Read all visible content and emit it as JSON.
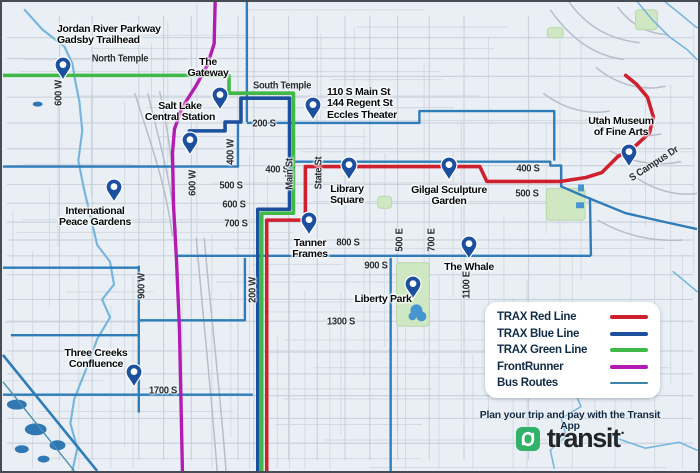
{
  "colors": {
    "red": "#cf2030",
    "blue": "#1c4f9e",
    "green": "#41b949",
    "frontrunner": "#b31cb3",
    "bus": "#2e7cb8",
    "bus_thin": "#4a8fb0",
    "bus_legend": "#3d85a8",
    "water": "#77b6dc",
    "water_fill": "#2f77b5",
    "pond": "#4596d0",
    "park": "#cfe7c2",
    "park_edge": "#b7d8a8",
    "pin": "#1c4f9e",
    "grid_minor": "#d4dae1",
    "grid_major": "#c6cdd6",
    "decor": "#b7bec8"
  },
  "legend": {
    "items": [
      {
        "label": "TRAX Red Line",
        "color": "red",
        "weight": 4
      },
      {
        "label": "TRAX Blue Line",
        "color": "blue",
        "weight": 4
      },
      {
        "label": "TRAX Green Line",
        "color": "green",
        "weight": 4
      },
      {
        "label": "FrontRunner",
        "color": "frontrunner",
        "weight": 4
      },
      {
        "label": "Bus Routes",
        "color": "bus_legend",
        "weight": 2
      }
    ]
  },
  "footer": {
    "tagline": "Plan your trip and pay with the Transit App",
    "brand": "transit",
    "mark": "·"
  },
  "map": {
    "street_labels": [
      {
        "text": "North Temple",
        "x": 118,
        "y": 57,
        "rot": 0
      },
      {
        "text": "600 W",
        "x": 57,
        "y": 91,
        "rot": -90
      },
      {
        "text": "South Temple",
        "x": 280,
        "y": 84,
        "rot": 0
      },
      {
        "text": "200 S",
        "x": 262,
        "y": 122,
        "rot": 0
      },
      {
        "text": "400 W",
        "x": 229,
        "y": 150,
        "rot": -90
      },
      {
        "text": "600 W",
        "x": 191,
        "y": 181,
        "rot": -90
      },
      {
        "text": "400 S",
        "x": 275,
        "y": 168,
        "rot": 0
      },
      {
        "text": "500 S",
        "x": 229,
        "y": 184,
        "rot": 0
      },
      {
        "text": "600 S",
        "x": 232,
        "y": 203,
        "rot": 0
      },
      {
        "text": "700 S",
        "x": 234,
        "y": 222,
        "rot": 0
      },
      {
        "text": "Main St",
        "x": 288,
        "y": 172,
        "rot": -90
      },
      {
        "text": "State St",
        "x": 317,
        "y": 171,
        "rot": -90
      },
      {
        "text": "800 S",
        "x": 346,
        "y": 241,
        "rot": 0
      },
      {
        "text": "900 S",
        "x": 374,
        "y": 264,
        "rot": 0
      },
      {
        "text": "500 E",
        "x": 398,
        "y": 238,
        "rot": -90
      },
      {
        "text": "700 E",
        "x": 430,
        "y": 238,
        "rot": -90
      },
      {
        "text": "1300 S",
        "x": 339,
        "y": 320,
        "rot": 0
      },
      {
        "text": "1100 E",
        "x": 465,
        "y": 283,
        "rot": -90
      },
      {
        "text": "900 W",
        "x": 140,
        "y": 284,
        "rot": -90
      },
      {
        "text": "200 W",
        "x": 251,
        "y": 288,
        "rot": -90
      },
      {
        "text": "1700 S",
        "x": 161,
        "y": 389,
        "rot": 0
      },
      {
        "text": "400 S",
        "x": 526,
        "y": 167,
        "rot": 0
      },
      {
        "text": "500 S",
        "x": 525,
        "y": 192,
        "rot": 0
      },
      {
        "text": "S Campus Dr",
        "x": 652,
        "y": 162,
        "rot": -33
      }
    ],
    "markers": [
      {
        "id": "jordan-river-parkway",
        "lines": [
          "Jordan River Parkway",
          "Gadsby Trailhead"
        ],
        "tip": [
          61,
          78
        ],
        "lx": 55,
        "ly": 22,
        "align": "left"
      },
      {
        "id": "the-gateway",
        "lines": [
          "The",
          "Gateway"
        ],
        "tip": [
          218,
          108
        ],
        "lx": 206,
        "ly": 55,
        "align": "center"
      },
      {
        "id": "salt-lake-central-station",
        "lines": [
          "Salt Lake",
          "Central Station"
        ],
        "tip": [
          188,
          153
        ],
        "lx": 178,
        "ly": 99,
        "align": "center"
      },
      {
        "id": "eccles-theater",
        "lines": [
          "110 S Main St",
          "144 Regent St",
          "Eccles Theater"
        ],
        "tip": [
          311,
          118
        ],
        "lx": 325,
        "ly": 85,
        "align": "left"
      },
      {
        "id": "library-square",
        "lines": [
          "Library",
          "Square"
        ],
        "tip": [
          347,
          178
        ],
        "lx": 345,
        "ly": 182,
        "align": "center"
      },
      {
        "id": "gilgal-sculpture-garden",
        "lines": [
          "Gilgal Sculpture",
          "Garden"
        ],
        "tip": [
          447,
          178
        ],
        "lx": 447,
        "ly": 183,
        "align": "center"
      },
      {
        "id": "utah-museum-of-fine-arts",
        "lines": [
          "Utah Museum",
          "of Fine Arts"
        ],
        "tip": [
          627,
          165
        ],
        "lx": 619,
        "ly": 114,
        "align": "center"
      },
      {
        "id": "international-peace-gardens",
        "lines": [
          "International",
          "Peace Gardens"
        ],
        "tip": [
          112,
          200
        ],
        "lx": 93,
        "ly": 204,
        "align": "center"
      },
      {
        "id": "tanner-frames",
        "lines": [
          "Tanner",
          "Frames"
        ],
        "tip": [
          307,
          233
        ],
        "lx": 308,
        "ly": 236,
        "align": "center"
      },
      {
        "id": "the-whale",
        "lines": [
          "The Whale"
        ],
        "tip": [
          467,
          257
        ],
        "lx": 467,
        "ly": 260,
        "align": "center"
      },
      {
        "id": "liberty-park",
        "lines": [
          "Liberty Park"
        ],
        "tip": [
          411,
          297
        ],
        "lx": 381,
        "ly": 292,
        "align": "center"
      },
      {
        "id": "three-creeks-confluence",
        "lines": [
          "Three Creeks",
          "Confluence"
        ],
        "tip": [
          132,
          385
        ],
        "lx": 94,
        "ly": 346,
        "align": "center"
      }
    ],
    "routes": [
      {
        "name": "bus-400-s-west",
        "color": "bus",
        "width": 2.4,
        "points": [
          [
            0,
            166
          ],
          [
            237,
            166
          ]
        ]
      },
      {
        "name": "bus-400-w",
        "color": "bus",
        "width": 2.4,
        "points": [
          [
            237,
            121
          ],
          [
            237,
            167
          ]
        ]
      },
      {
        "name": "bus-300-w",
        "color": "bus",
        "width": 2.4,
        "points": [
          [
            246,
            0
          ],
          [
            246,
            121
          ]
        ]
      },
      {
        "name": "bus-200-s",
        "color": "bus",
        "width": 2.4,
        "points": [
          [
            246,
            122
          ],
          [
            420,
            122
          ],
          [
            420,
            110
          ],
          [
            556,
            110
          ],
          [
            556,
            160
          ]
        ]
      },
      {
        "name": "bus-400-s-east",
        "color": "bus",
        "width": 2.4,
        "points": [
          [
            293,
            161
          ],
          [
            552,
            161
          ],
          [
            552,
            165
          ],
          [
            563,
            165
          ],
          [
            563,
            186
          ],
          [
            584,
            195
          ],
          [
            628,
            213
          ],
          [
            668,
            222
          ],
          [
            700,
            229
          ]
        ]
      },
      {
        "name": "bus-900-s",
        "color": "bus",
        "width": 2.4,
        "points": [
          [
            174,
            256
          ],
          [
            593,
            256
          ]
        ]
      },
      {
        "name": "bus-900-s-connector",
        "color": "bus",
        "width": 2.4,
        "points": [
          [
            592,
            197
          ],
          [
            593,
            256
          ]
        ]
      },
      {
        "name": "bus-600-e",
        "color": "bus",
        "width": 2.4,
        "points": [
          [
            391,
            258
          ],
          [
            391,
            473
          ]
        ]
      },
      {
        "name": "bus-200-w",
        "color": "bus",
        "width": 2.4,
        "points": [
          [
            244,
            258
          ],
          [
            244,
            321
          ],
          [
            137,
            321
          ]
        ]
      },
      {
        "name": "bus-900-w",
        "color": "bus",
        "width": 2.4,
        "points": [
          [
            137,
            266
          ],
          [
            137,
            414
          ]
        ]
      },
      {
        "name": "bus-california-ave",
        "color": "bus",
        "width": 2.4,
        "points": [
          [
            0,
            268
          ],
          [
            137,
            268
          ]
        ]
      },
      {
        "name": "bus-1300-s-west",
        "color": "bus",
        "width": 2.4,
        "points": [
          [
            8,
            336
          ],
          [
            137,
            336
          ]
        ]
      },
      {
        "name": "bus-1700-s",
        "color": "bus",
        "width": 2.4,
        "points": [
          [
            0,
            396
          ],
          [
            252,
            396
          ]
        ]
      },
      {
        "name": "bus-diagonal-sw",
        "color": "bus",
        "width": 2.6,
        "points": [
          [
            0,
            356
          ],
          [
            95,
            473
          ]
        ]
      },
      {
        "name": "bus-thin-sw",
        "color": "bus_thin",
        "width": 1.4,
        "points": [
          [
            0,
            383
          ],
          [
            72,
            473
          ]
        ]
      },
      {
        "name": "trax-green-line",
        "color": "green",
        "width": 3.6,
        "points": [
          [
            0,
            74
          ],
          [
            228,
            74
          ],
          [
            228,
            92
          ],
          [
            293,
            92
          ],
          [
            293,
            213
          ],
          [
            261,
            213
          ],
          [
            261,
            473
          ]
        ]
      },
      {
        "name": "trax-blue-line",
        "color": "blue",
        "width": 3.6,
        "points": [
          [
            188,
            140
          ],
          [
            188,
            130
          ],
          [
            224,
            130
          ],
          [
            224,
            121
          ],
          [
            240,
            121
          ],
          [
            240,
            97
          ],
          [
            289,
            97
          ],
          [
            289,
            209
          ],
          [
            257,
            209
          ],
          [
            257,
            473
          ]
        ]
      },
      {
        "name": "trax-red-line",
        "color": "red",
        "width": 3.6,
        "cap": "round",
        "points": [
          [
            266,
            473
          ],
          [
            266,
            220
          ],
          [
            305,
            220
          ],
          [
            305,
            166
          ],
          [
            481,
            166
          ],
          [
            488,
            181
          ],
          [
            562,
            181
          ],
          [
            588,
            177
          ],
          [
            604,
            172
          ],
          [
            620,
            156
          ],
          [
            638,
            145
          ],
          [
            652,
            132
          ],
          [
            656,
            116
          ],
          [
            650,
            96
          ],
          [
            639,
            83
          ],
          [
            628,
            74
          ]
        ]
      },
      {
        "name": "frontrunner-line",
        "color": "frontrunner",
        "width": 3.4,
        "cap": "round",
        "points": [
          [
            214,
            0
          ],
          [
            213,
            42
          ],
          [
            206,
            64
          ],
          [
            195,
            84
          ],
          [
            181,
            106
          ],
          [
            173,
            128
          ],
          [
            171,
            152
          ],
          [
            172,
            205
          ],
          [
            175,
            260
          ],
          [
            178,
            330
          ],
          [
            181,
            473
          ]
        ]
      }
    ],
    "water": [
      {
        "name": "jordan-river",
        "width": 2.2,
        "points": [
          [
            22,
            8
          ],
          [
            40,
            28
          ],
          [
            62,
            45
          ],
          [
            70,
            62
          ],
          [
            73,
            80
          ],
          [
            77,
            100
          ],
          [
            80,
            130
          ],
          [
            76,
            160
          ],
          [
            82,
            190
          ],
          [
            88,
            215
          ],
          [
            95,
            245
          ],
          [
            108,
            262
          ],
          [
            112,
            285
          ],
          [
            100,
            300
          ],
          [
            108,
            318
          ],
          [
            95,
            340
          ],
          [
            88,
            360
          ],
          [
            80,
            380
          ],
          [
            72,
            400
          ],
          [
            68,
            425
          ],
          [
            75,
            450
          ],
          [
            70,
            473
          ]
        ]
      },
      {
        "name": "red-butte-creek-1",
        "width": 1.6,
        "points": [
          [
            640,
            0
          ],
          [
            655,
            18
          ],
          [
            672,
            35
          ],
          [
            690,
            48
          ],
          [
            700,
            58
          ]
        ]
      },
      {
        "name": "red-butte-creek-2",
        "width": 1.6,
        "points": [
          [
            668,
            0
          ],
          [
            683,
            12
          ],
          [
            695,
            22
          ],
          [
            700,
            26
          ]
        ]
      },
      {
        "name": "creek-southeast",
        "width": 1.6,
        "points": [
          [
            597,
            382
          ],
          [
            577,
            394
          ],
          [
            583,
            408
          ],
          [
            563,
            420
          ],
          [
            568,
            438
          ],
          [
            552,
            452
          ],
          [
            556,
            470
          ]
        ]
      },
      {
        "name": "creek-southeast-2",
        "width": 1.6,
        "points": [
          [
            610,
            437
          ],
          [
            648,
            450
          ],
          [
            682,
            444
          ],
          [
            700,
            452
          ]
        ]
      },
      {
        "name": "creek-east",
        "width": 1.6,
        "points": [
          [
            676,
            272
          ],
          [
            700,
            292
          ]
        ]
      }
    ],
    "parks": [
      {
        "name": "liberty-park",
        "x": 397,
        "y": 263,
        "w": 33,
        "h": 64
      },
      {
        "name": "park-east",
        "x": 548,
        "y": 188,
        "w": 39,
        "h": 32
      },
      {
        "name": "park-small",
        "x": 378,
        "y": 196,
        "w": 14,
        "h": 12
      },
      {
        "name": "park-northeast",
        "x": 638,
        "y": 8,
        "w": 22,
        "h": 20
      },
      {
        "name": "park-northeast-2",
        "x": 549,
        "y": 26,
        "w": 16,
        "h": 10
      }
    ],
    "ponds": [
      {
        "x": 14,
        "y": 406,
        "rx": 10,
        "ry": 5
      },
      {
        "x": 33,
        "y": 431,
        "rx": 11,
        "ry": 6
      },
      {
        "x": 55,
        "y": 447,
        "rx": 8,
        "ry": 5
      },
      {
        "x": 19,
        "y": 451,
        "rx": 7,
        "ry": 4
      },
      {
        "x": 41,
        "y": 461,
        "rx": 6,
        "ry": 3.5
      },
      {
        "x": 35,
        "y": 103,
        "rx": 5,
        "ry": 2.5
      }
    ],
    "blue_squares": [
      {
        "x": 580,
        "y": 184,
        "w": 6,
        "h": 7
      },
      {
        "x": 578,
        "y": 202,
        "w": 8,
        "h": 6
      }
    ],
    "liberty_pond": [
      {
        "cx": 417,
        "cy": 311,
        "r": 6
      },
      {
        "cx": 422,
        "cy": 317,
        "r": 5
      },
      {
        "cx": 413,
        "cy": 317,
        "r": 4
      }
    ]
  }
}
